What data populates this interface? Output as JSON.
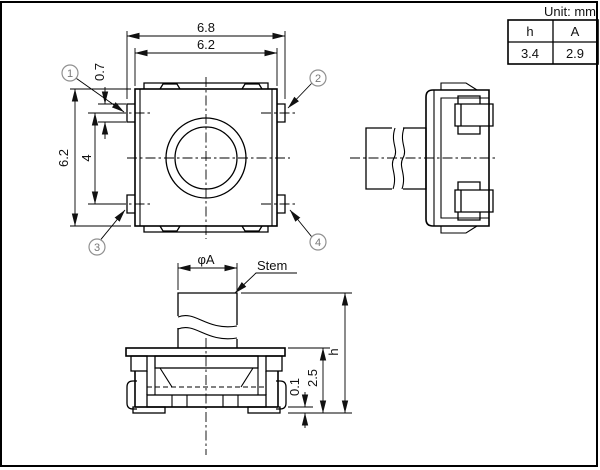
{
  "unit_label": "Unit: mm",
  "table": {
    "col1_header": "h",
    "col2_header": "A",
    "col1_value": "3.4",
    "col2_value": "2.9"
  },
  "top_view": {
    "dim_overall_width": "6.8",
    "dim_body_width": "6.2",
    "dim_body_height": "6.2",
    "dim_terminal_pitch": "4",
    "dim_terminal_height": "0.7",
    "callout_1": "1",
    "callout_2": "2",
    "callout_3": "3",
    "callout_4": "4"
  },
  "front_view": {
    "dim_stem_diameter": "φA",
    "stem_label": "Stem",
    "dim_total_height": "h",
    "dim_body_height": "2.5",
    "dim_terminal_standoff": "0.1"
  }
}
